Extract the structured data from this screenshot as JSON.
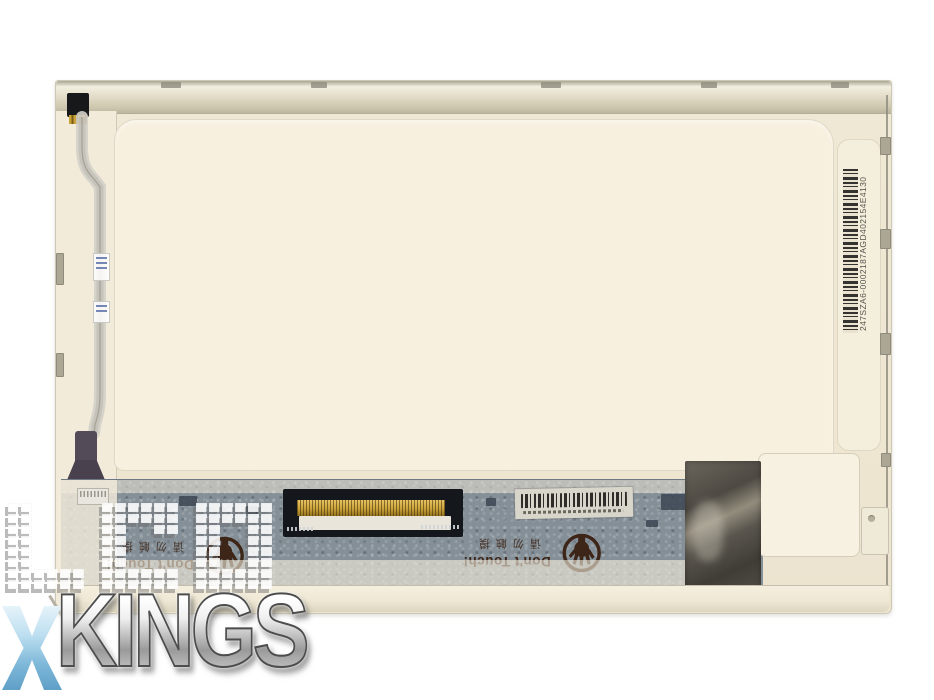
{
  "product": {
    "name": "laptop-lcd-screen-panel-back",
    "serial": "247SZA6-0002187AGD402154E4130",
    "warning": {
      "english": "Don't Touch!",
      "chinese": "请勿触摸"
    },
    "watermark": {
      "line1": "LCD",
      "line2": "KINGS"
    },
    "colors": {
      "background": "#ffffff",
      "panel_cream": "#eee6d1",
      "panel_recess": "#f7f0df",
      "metal_rail": "#d9d3bd",
      "pcb_green_gray": "#848f97",
      "connector_black": "#14181c",
      "connector_gold": "#c9a23a",
      "foil_tape": "#55514a",
      "warning_ink": "#3d2517",
      "watermark_blue": "#7db7d8",
      "watermark_silver": "#c9c9c9"
    }
  }
}
